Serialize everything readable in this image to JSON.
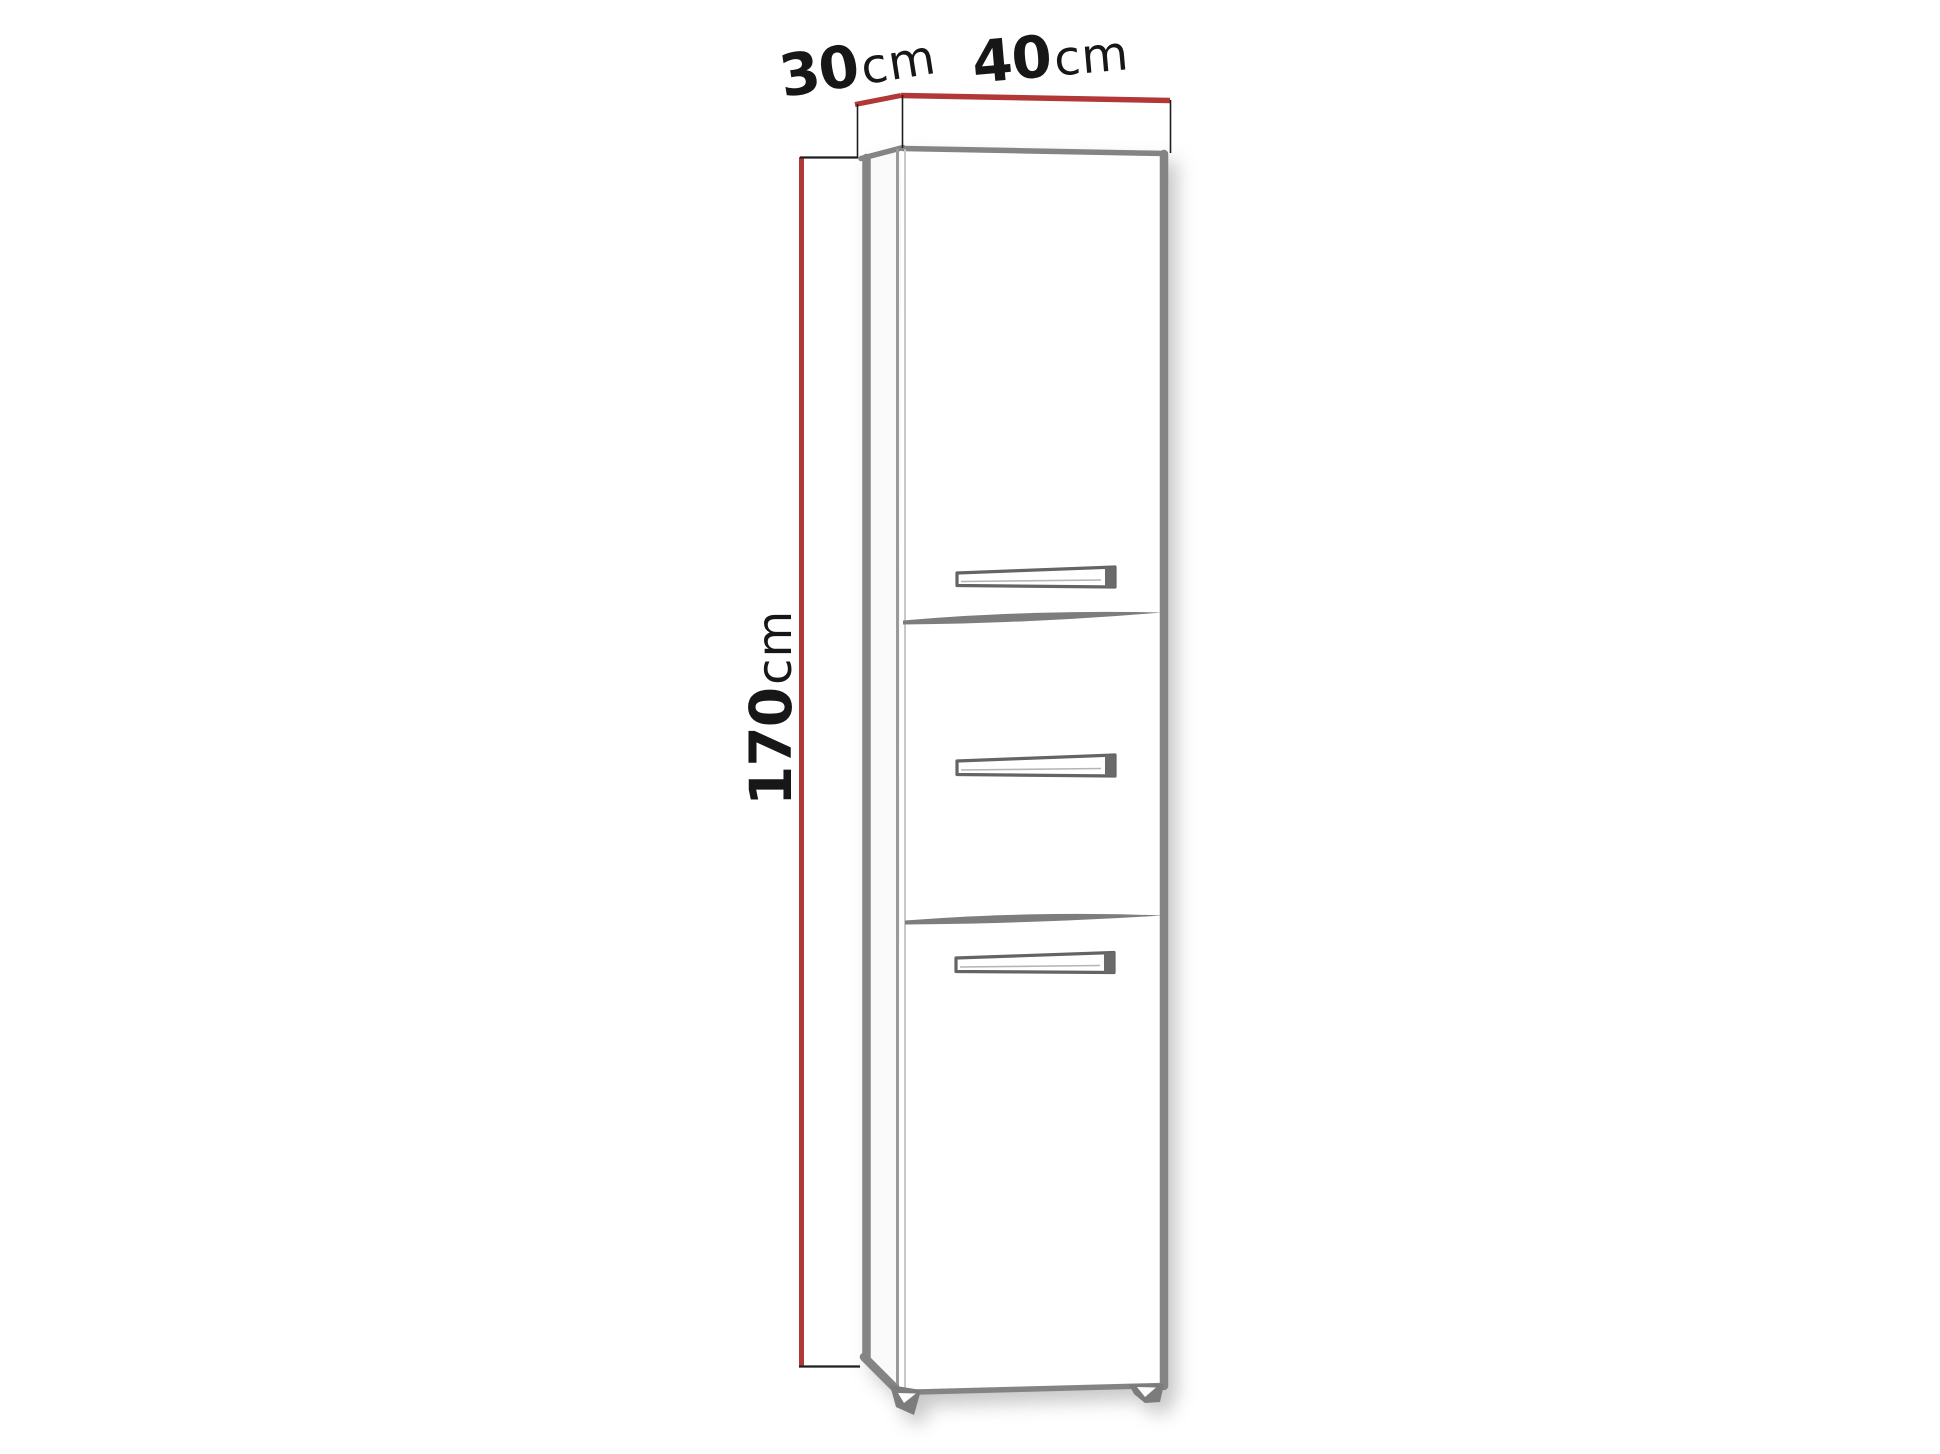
{
  "diagram": {
    "subject": "tall cabinet with three door fronts and handles, shown in slight left perspective",
    "dimensions": [
      {
        "id": "depth",
        "value": "30",
        "unit": "cm"
      },
      {
        "id": "width",
        "value": "40",
        "unit": "cm"
      },
      {
        "id": "height",
        "value": "170",
        "unit": "cm"
      }
    ]
  },
  "colors": {
    "background": "#ffffff",
    "dimension_line_red": "#b23737",
    "extension_line": "#1f1f1f",
    "label_text": "#171717",
    "cabinet_edge": "#848484",
    "cabinet_fill": "#ffffff",
    "handle_outline": "#646464"
  }
}
